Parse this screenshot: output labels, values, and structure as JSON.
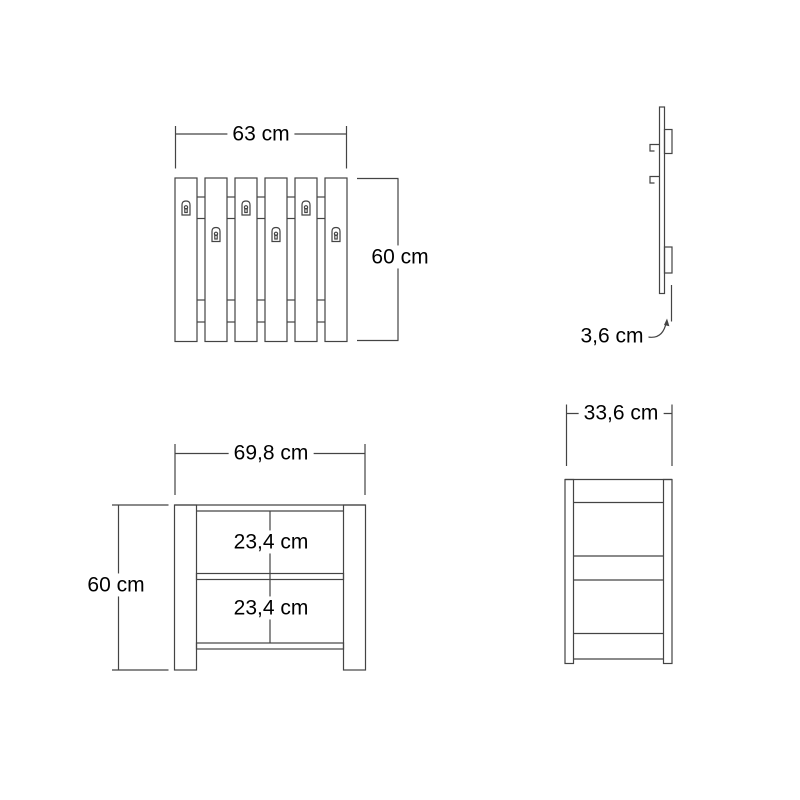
{
  "background": "#ffffff",
  "line_color": "#444444",
  "text_color": "#000000",
  "views": {
    "coat_rack_front": {
      "width_dim": "63 cm",
      "height_dim": "60 cm"
    },
    "coat_rack_side": {
      "thickness_dim": "3,6 cm"
    },
    "bench_front": {
      "width_dim": "69,8 cm",
      "height_dim": "60 cm",
      "upper_compartment_dim": "23,4 cm",
      "lower_compartment_dim": "23,4 cm"
    },
    "bench_side": {
      "depth_dim": "33,6 cm"
    }
  }
}
